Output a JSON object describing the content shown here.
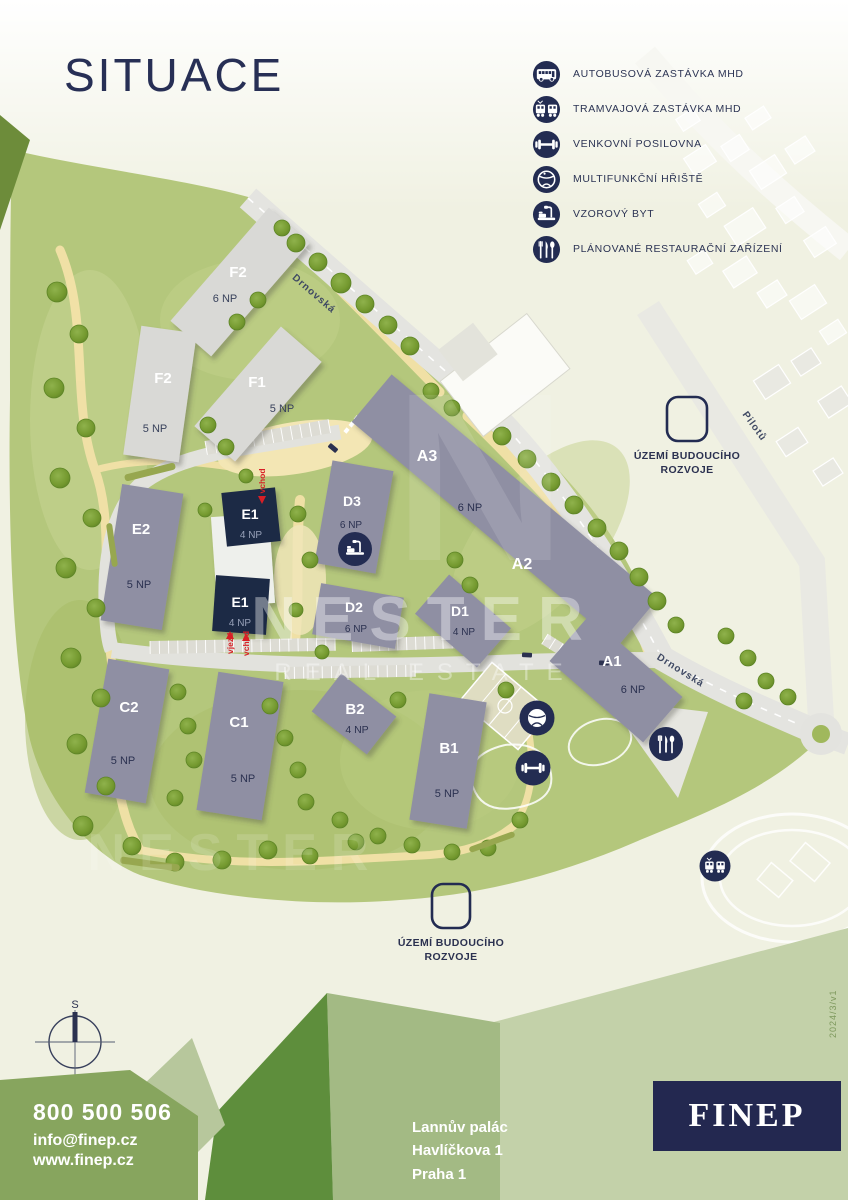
{
  "title": "SITUACE",
  "legend": {
    "items": [
      {
        "icon": "bus-icon",
        "label": "AUTOBUSOVÁ ZASTÁVKA MHD"
      },
      {
        "icon": "tram-icon",
        "label": "TRAMVAJOVÁ ZASTÁVKA MHD"
      },
      {
        "icon": "outdoor-gym-icon",
        "label": "VENKOVNÍ POSILOVNA"
      },
      {
        "icon": "multifunction-court-icon",
        "label": "MULTIFUNKČNÍ HŘIŠTĚ"
      },
      {
        "icon": "show-apartment-icon",
        "label": "VZOROVÝ BYT"
      },
      {
        "icon": "restaurant-icon",
        "label": "PLÁNOVANÉ RESTAURAČNÍ ZAŘÍZENÍ"
      }
    ]
  },
  "map": {
    "buildings": [
      {
        "id": "f2-north",
        "label": "F2",
        "floors": "6 NP"
      },
      {
        "id": "f2-west",
        "label": "F2",
        "floors": "5 NP"
      },
      {
        "id": "f1",
        "label": "F1",
        "floors": "5 NP"
      },
      {
        "id": "a3",
        "label": "A3",
        "floors": "6 NP"
      },
      {
        "id": "a2",
        "label": "A2",
        "floors": ""
      },
      {
        "id": "a1",
        "label": "A1",
        "floors": "6 NP"
      },
      {
        "id": "b1",
        "label": "B1",
        "floors": "5 NP"
      },
      {
        "id": "b2",
        "label": "B2",
        "floors": "4 NP"
      },
      {
        "id": "c1",
        "label": "C1",
        "floors": "5 NP"
      },
      {
        "id": "c2",
        "label": "C2",
        "floors": "5 NP"
      },
      {
        "id": "d1",
        "label": "D1",
        "floors": "4 NP"
      },
      {
        "id": "d2",
        "label": "D2",
        "floors": "6 NP"
      },
      {
        "id": "d3",
        "label": "D3",
        "floors": "6 NP"
      },
      {
        "id": "e1-north",
        "label": "E1",
        "floors": "4 NP"
      },
      {
        "id": "e1-south",
        "label": "E1",
        "floors": "4 NP"
      },
      {
        "id": "e2",
        "label": "E2",
        "floors": "5 NP"
      }
    ],
    "streets": [
      {
        "name": "Drnovská"
      },
      {
        "name": "Drnovská"
      },
      {
        "name": "Pilotů"
      }
    ],
    "future_area": {
      "line1": "ÚZEMÍ BUDOUCÍHO",
      "line2": "ROZVOJE"
    },
    "entrances": {
      "vchod": "vchod",
      "vjezd": "vjezd"
    },
    "compass": {
      "north": "S"
    },
    "watermark": {
      "initial": "N",
      "name": "NESTER",
      "tagline": "REAL ESTATE"
    }
  },
  "footer": {
    "phone": "800 500 506",
    "email": "info@finep.cz",
    "web": "www.finep.cz",
    "address": [
      "Lannův palác",
      "Havlíčkova 1",
      "Praha 1"
    ],
    "logo": "FINEP",
    "version": "2024/3/v1"
  },
  "colors": {
    "navy": "#232c52",
    "building_gray": "#8f8fa3",
    "highlight_building": "#1d2945",
    "red": "#d81f26",
    "footer_green": "#87a55e"
  }
}
